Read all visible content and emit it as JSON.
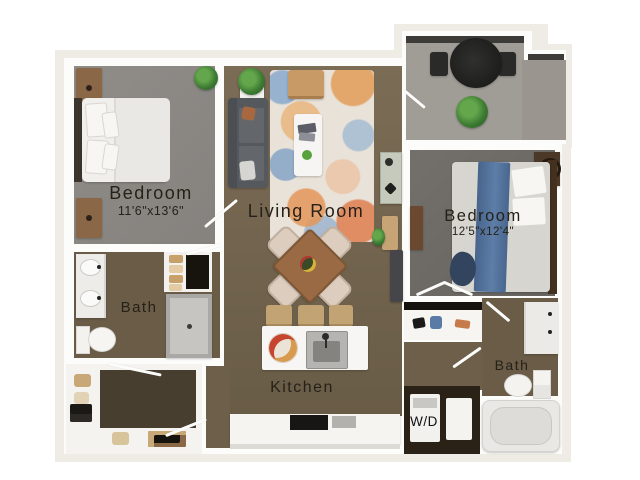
{
  "floorplan": {
    "rooms": {
      "bedroom1": {
        "name": "Bedroom",
        "dimensions": "11'6\"x13'6\""
      },
      "living_room": {
        "name": "Living Room"
      },
      "bedroom2": {
        "name": "Bedroom",
        "dimensions": "12'5\"x12'4\""
      },
      "bath1": {
        "name": "Bath"
      },
      "bath2": {
        "name": "Bath"
      },
      "kitchen": {
        "name": "Kitchen"
      },
      "laundry": {
        "name": "W/D"
      }
    },
    "colors": {
      "page_background": "#ffffff",
      "plan_slab": "#efece6",
      "wall": "#fcfcfb",
      "wood_floor": "#786951",
      "bedroom1_floor": "#8b8884",
      "bedroom2_floor": "#6e6b66",
      "bath_floor": "#6a5c47",
      "closet_floor": "#483e30",
      "balcony_floor": "#a09c96",
      "balcony_rail": "#3c3b38",
      "label_text": "#262118",
      "accent_blue_throw": "#54749c",
      "accent_sofa": "#55595d"
    },
    "furniture": [
      "bed",
      "nightstand",
      "plant",
      "sofa",
      "rug",
      "coffee-table",
      "armchair",
      "console",
      "dining-table",
      "dining-chair",
      "kitchen-island",
      "bar-stool",
      "sink",
      "stove",
      "refrigerator",
      "vanity",
      "toilet",
      "shower",
      "bathtub",
      "linen-closet",
      "washer-dryer",
      "balcony-table",
      "balcony-chair",
      "dresser",
      "speaker"
    ]
  }
}
